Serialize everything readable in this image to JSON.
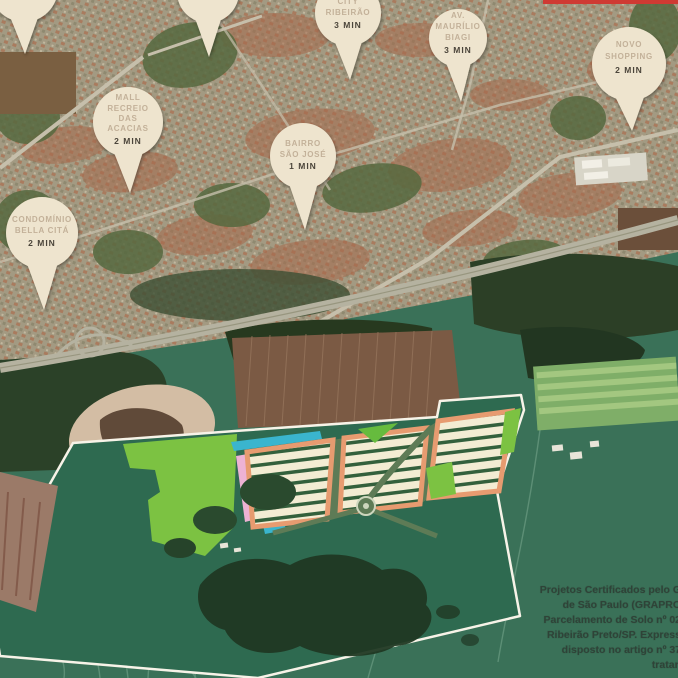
{
  "map": {
    "pins": [
      {
        "id": "cut-pin-1",
        "label_lines": [],
        "time": "",
        "cx": 24,
        "cy": -12,
        "r": 34,
        "tipx": 25,
        "tipy": 54,
        "text_baselines": [],
        "time_y": 0
      },
      {
        "id": "cut-pin-2",
        "label_lines": [],
        "time": "",
        "cx": 208,
        "cy": -8,
        "r": 31,
        "tipx": 209,
        "tipy": 57,
        "text_baselines": [],
        "time_y": 0
      },
      {
        "id": "city-ribeirao",
        "label_lines": [
          "CITY",
          "RIBEIRÃO"
        ],
        "time": "3 MIN",
        "cx": 348,
        "cy": 13,
        "r": 33,
        "tipx": 350,
        "tipy": 80,
        "text_baselines": [
          4,
          15
        ],
        "time_y": 28
      },
      {
        "id": "av-maurilio-biagi",
        "label_lines": [
          "AV.",
          "MAURÍLIO",
          "BIAGI"
        ],
        "time": "3 MIN",
        "cx": 458,
        "cy": 38,
        "r": 29,
        "tipx": 461,
        "tipy": 102,
        "text_baselines": [
          18,
          29,
          40
        ],
        "time_y": 53
      },
      {
        "id": "novo-shopping",
        "label_lines": [
          "NOVO",
          "SHOPPING"
        ],
        "time": "2 MIN",
        "cx": 629,
        "cy": 64,
        "r": 37,
        "tipx": 632,
        "tipy": 131,
        "text_baselines": [
          47,
          59
        ],
        "time_y": 73
      },
      {
        "id": "mall-recreio-das-acacias",
        "label_lines": [
          "MALL",
          "RECREIO",
          "DAS",
          "ACACIAS"
        ],
        "time": "2 MIN",
        "cx": 128,
        "cy": 122,
        "r": 35,
        "tipx": 130,
        "tipy": 193,
        "text_baselines": [
          100,
          111,
          121,
          131
        ],
        "time_y": 144
      },
      {
        "id": "bairro-sao-jose",
        "label_lines": [
          "BAIRRO",
          "SÃO JOSÉ"
        ],
        "time": "1 MIN",
        "cx": 303,
        "cy": 156,
        "r": 33,
        "tipx": 305,
        "tipy": 230,
        "text_baselines": [
          146,
          157
        ],
        "time_y": 169
      },
      {
        "id": "condominio-bella-cita",
        "label_lines": [
          "CONDOMÍNIO",
          "BELLA CITÁ"
        ],
        "time": "2 MIN",
        "cx": 42,
        "cy": 233,
        "r": 36,
        "tipx": 44,
        "tipy": 310,
        "text_baselines": [
          222,
          233
        ],
        "time_y": 246
      }
    ]
  },
  "legal": {
    "lines": [
      "Projetos Certificados pelo G",
      "de São Paulo (GRAPRO",
      "Parcelamento de Solo nº 02",
      "Ribeirão Preto/SP. Express",
      "disposto no artigo nº 37",
      "tratan"
    ]
  },
  "colors": {
    "pin_fill": "#eee4ce",
    "pin_label_text": "#c3b199",
    "pin_time_text": "#4c453a",
    "legal_text": "#2f4238",
    "plan_salmon": "#e79b70",
    "plan_cyan": "#3ab5ce",
    "plan_pink": "#edb2d4",
    "plan_light_green": "#7cc242",
    "plan_lot_cream": "#f3ecd3",
    "parcel_boundary": "#f7f3e8",
    "red_banner": "#cf3a33"
  }
}
